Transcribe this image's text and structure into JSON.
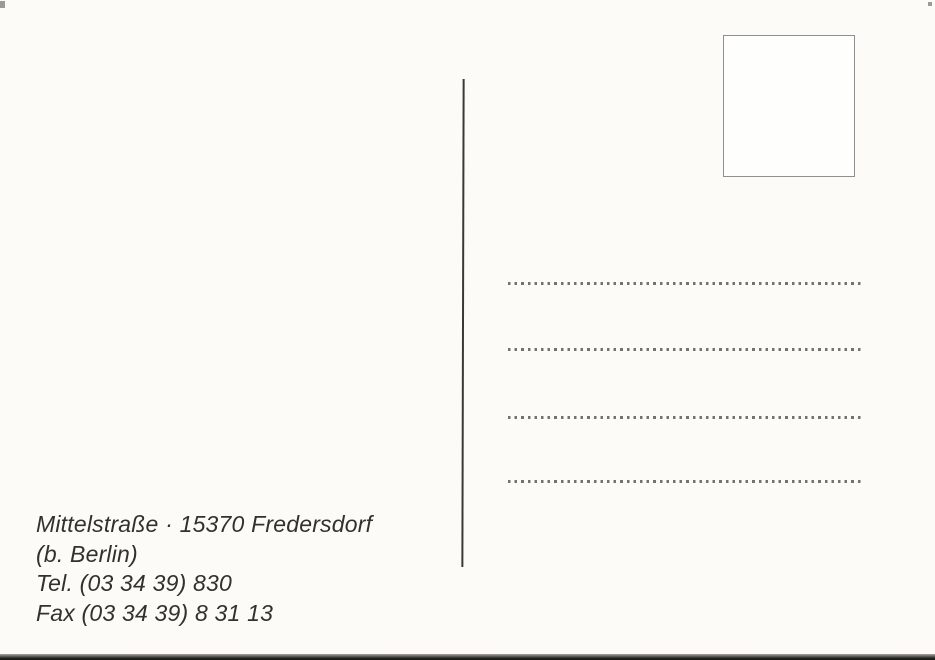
{
  "postcard": {
    "sender": {
      "line1": "Mittelstraße · 15370 Fredersdorf",
      "line2": "(b. Berlin)",
      "line3": "Tel. (03 34 39) 830",
      "line4": "Fax (03 34 39) 8 31 13"
    },
    "address_field": {
      "dotted_line_count": 4
    },
    "stamp_box": {
      "content": ""
    },
    "colors": {
      "card_background": "#fcfbf7",
      "ink": "#32322c",
      "dot_gray": "#73736d",
      "divider": "#3a3a33",
      "stamp_border": "#90908a",
      "scan_edge": "#151513"
    }
  }
}
